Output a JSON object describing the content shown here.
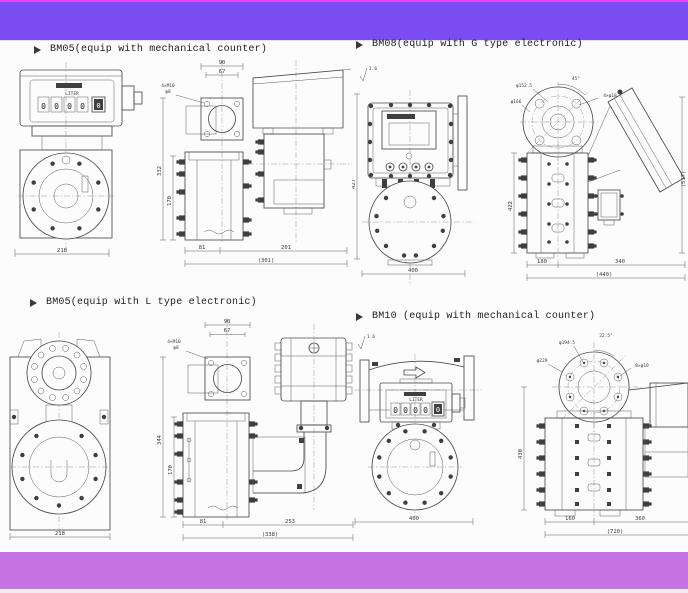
{
  "banner": {
    "top_color": "#7b4cf2",
    "bottom_color": "#c873e3",
    "edge_color": "#f23ef0"
  },
  "icons": {
    "section_bullet": "arrowhead-right",
    "surface_roughness": "check-mark"
  },
  "sections": {
    "bm05_mech": {
      "title": "BM05(equip with mechanical counter)",
      "counter": {
        "label": "LITER",
        "digits": [
          "0",
          "0",
          "0",
          "0"
        ],
        "small_digit": "0"
      },
      "dims": {
        "front_width": "218",
        "top_width": "90",
        "top_inner": "67",
        "bolt_note": "4×M10",
        "bolt_depth": "φ8",
        "height_total": "332",
        "height_mid": "170",
        "base_left": "81",
        "base_right": "201",
        "base_total": "(301)"
      }
    },
    "bm08_g": {
      "title": "BM08(equip with G type electronic)",
      "surface_note": "1.6",
      "dims": {
        "front_width": "400",
        "front_height": "427",
        "flange_bolt_circle": "φ152.5",
        "flange_od": "φ166",
        "bolt_angle": "45°",
        "bolt_note": "4×φ18",
        "side_height": "422",
        "overall_height": "(517)",
        "base_left": "180",
        "base_right": "340",
        "base_total": "(440)"
      }
    },
    "bm05_l": {
      "title": "BM05(equip with L type electronic)",
      "dims": {
        "front_width": "218",
        "top_width": "90",
        "top_inner": "67",
        "bolt_note": "4×M10",
        "bolt_depth": "φ8",
        "height_total": "344",
        "height_mid": "170",
        "base_left": "81",
        "base_right": "253",
        "base_total": "(338)"
      }
    },
    "bm10_mech": {
      "title": "BM10 (equip with mechanical counter)",
      "surface_note": "1.6",
      "counter": {
        "label": "LITER",
        "digits": [
          "0",
          "0",
          "0",
          "0"
        ],
        "small_digit": "0"
      },
      "dims": {
        "front_width": "400",
        "flange_bolt_circle": "φ194.5",
        "flange_od": "φ229",
        "bolt_angle": "22.5°",
        "bolt_note": "8×φ19",
        "side_height": "430",
        "base_left": "160",
        "base_right": "360",
        "base_total": "(720)"
      }
    }
  }
}
